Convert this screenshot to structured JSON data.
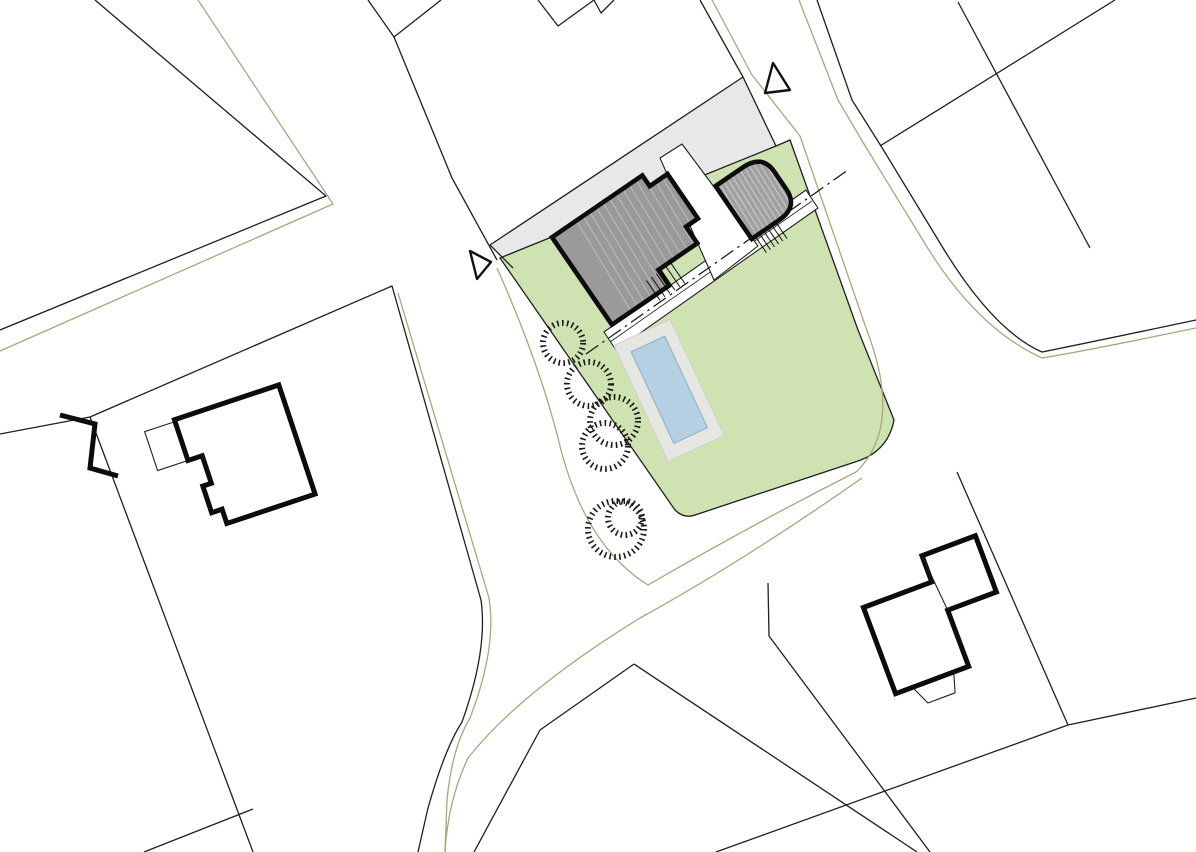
{
  "meta": {
    "type": "architectural-site-plan",
    "description": "Black-and-white cadastral site plan with highlighted project parcel: lawn, main house, garage, terrace, pool, shrubs, access road markers"
  },
  "canvas": {
    "w": 1196,
    "h": 852,
    "bg": "#ffffff"
  },
  "palette": {
    "line": "#1f1f1f",
    "thick": "#0c0c0c",
    "olive": "#a8a67e",
    "driveway": "#e8e8e8",
    "lawn": "#cfe3b2",
    "building_main": "#9a9a9a",
    "building_garage": "#a1a1a1",
    "pool_water": "#b5cfe3",
    "pool_edge": "#98b4c9",
    "deck": "#e6e6e3",
    "white": "#ffffff",
    "hatch_light": "rgba(255,255,255,0.5)",
    "roof_light": "rgba(255,255,255,0.38)",
    "deck_edge": "#d0d0ce"
  },
  "layers": [
    {
      "kind": "polygon",
      "name": "driveway-strip",
      "pts": "743,77 490,245 513,268 776,146",
      "fill": "#e8e8e8",
      "stroke": "none"
    },
    {
      "kind": "path",
      "name": "lawn-parcel",
      "d": "M 500,258 L 675,510 Q 684,519 695,515 L 855,462 Q 888,452 894,420 L 858,330 L 790,140 L 776,146 Z",
      "fill": "#cfe3b2",
      "stroke": "#1f1f1f",
      "w": 1.3
    },
    {
      "kind": "path",
      "name": "driveway-edge-line",
      "d": "M 743,77 L 490,245 M 490,245 L 513,268",
      "fill": "none",
      "stroke": "#1f1f1f",
      "w": 1.3
    },
    {
      "kind": "path",
      "name": "parcel-line-topleft",
      "d": "M 95,0 L 326,196 L 0,330",
      "fill": "none",
      "stroke": "#1f1f1f",
      "w": 1.3
    },
    {
      "kind": "path",
      "name": "parcel-line-v-notch",
      "d": "M 368,0 L 394,37 L 441,0",
      "fill": "none",
      "stroke": "#1f1f1f",
      "w": 1.3
    },
    {
      "kind": "path",
      "name": "road-edge-west-upper",
      "d": "M 394,37 L 452,178 L 497,260",
      "fill": "none",
      "stroke": "#1f1f1f",
      "w": 1.3
    },
    {
      "kind": "path",
      "name": "parcel-line-w-notch",
      "d": "M 538,0 L 558,26 L 594,0 M 594,0 L 601,13 L 614,0",
      "fill": "none",
      "stroke": "#1f1f1f",
      "w": 1.3
    },
    {
      "kind": "path",
      "name": "road-edge-west-of-drive",
      "d": "M 700,0 L 743,77 L 776,146",
      "fill": "none",
      "stroke": "#1f1f1f",
      "w": 1.3
    },
    {
      "kind": "path",
      "name": "road-edge-east",
      "d": "M 817,0 L 852,100 L 881,146 L 940,243 Q 992,330 1042,352 Q 1092,342 1196,320",
      "fill": "none",
      "stroke": "#1f1f1f",
      "w": 1.3
    },
    {
      "kind": "path",
      "name": "parcel-line-topright-1",
      "d": "M 958,2 L 1090,248",
      "fill": "none",
      "stroke": "#1f1f1f",
      "w": 1.3
    },
    {
      "kind": "path",
      "name": "parcel-line-topright-2",
      "d": "M 1115,0 L 880,146",
      "fill": "none",
      "stroke": "#1f1f1f",
      "w": 1.3
    },
    {
      "kind": "path",
      "name": "parcel-line-left",
      "d": "M 0,434 L 90,417 L 392,286 L 481,600 Q 488,650 462,722 Q 445,748 428,808 L 418,852",
      "fill": "none",
      "stroke": "#1f1f1f",
      "w": 1.3
    },
    {
      "kind": "path",
      "name": "parcel-line-left-west",
      "d": "M 90,417 L 253,852",
      "fill": "none",
      "stroke": "#1f1f1f",
      "w": 1.3
    },
    {
      "kind": "path",
      "name": "parcel-line-left-bottom",
      "d": "M 144,852 L 253,809",
      "fill": "none",
      "stroke": "#1f1f1f",
      "w": 1.3
    },
    {
      "kind": "path",
      "name": "parcel-line-south-peak",
      "d": "M 634,664 L 540,730 L 474,852 M 634,664 L 917,852",
      "fill": "none",
      "stroke": "#1f1f1f",
      "w": 1.3
    },
    {
      "kind": "path",
      "name": "parcel-line-southeast",
      "d": "M 957,472 L 1068,725 M 1068,725 L 1196,698 M 1068,725 L 716,852",
      "fill": "none",
      "stroke": "#1f1f1f",
      "w": 1.3
    },
    {
      "kind": "path",
      "name": "parcel-line-right-house",
      "d": "M 768,583 L 769,636 L 930,852",
      "fill": "none",
      "stroke": "#1f1f1f",
      "w": 1.3
    },
    {
      "kind": "path",
      "name": "olive-line-topleft",
      "d": "M 198,0 L 333,204 L 0,351",
      "fill": "none",
      "stroke": "#a8a67e",
      "w": 1.3
    },
    {
      "kind": "path",
      "name": "olive-line-junction-loop",
      "d": "M 497,268 Q 538,360 558,438 Q 583,545 648,585 Q 755,523 856,472",
      "fill": "none",
      "stroke": "#a8a67e",
      "w": 1.3
    },
    {
      "kind": "path",
      "name": "olive-line-east-offset",
      "d": "M 800,136 L 866,328 Q 904,426 856,472",
      "fill": "none",
      "stroke": "#a8a67e",
      "w": 1.3
    },
    {
      "kind": "path",
      "name": "olive-line-sweep",
      "d": "M 862,478 Q 745,560 640,618 Q 520,692 468,758 Q 448,800 445,852",
      "fill": "none",
      "stroke": "#a8a67e",
      "w": 1.3
    },
    {
      "kind": "path",
      "name": "olive-line-left-road",
      "d": "M 398,293 L 489,598 Q 497,648 470,718 Q 452,748 447,800 L 445,852",
      "fill": "none",
      "stroke": "#a8a67e",
      "w": 1.3
    },
    {
      "kind": "path",
      "name": "olive-line-top-road-west",
      "d": "M 712,0 L 752,75 L 800,136",
      "fill": "none",
      "stroke": "#a8a67e",
      "w": 1.3
    },
    {
      "kind": "path",
      "name": "olive-line-top-road-east",
      "d": "M 799,0 L 838,100 L 864,144 L 924,242 Q 976,328 1042,358 Q 1090,350 1196,328",
      "fill": "none",
      "stroke": "#a8a67e",
      "w": 1.3
    },
    {
      "kind": "polygon",
      "name": "terrace-band",
      "pts": "604,332 806,190 818,208 616,350",
      "fill": "#ffffff",
      "stroke": "#1f1f1f",
      "w": 1.1
    },
    {
      "kind": "path",
      "name": "terrace-band-inner-line",
      "d": "M 610,342 L 812,201",
      "fill": "none",
      "stroke": "#1f1f1f",
      "w": 0.8
    },
    {
      "kind": "polygon",
      "name": "terrace-gap",
      "pts": "660,158 682,144 758,246 714,280",
      "fill": "#ffffff",
      "stroke": "#1f1f1f",
      "w": 1.1
    },
    {
      "kind": "group",
      "name": "pool-group",
      "transform": "rotate(-25 670 390)",
      "children": [
        {
          "kind": "rect",
          "name": "pool-deck",
          "x": 638,
          "y": 326,
          "wd": 62,
          "ht": 128,
          "fill": "#e6e6e3",
          "stroke": "#d0d0ce",
          "w": 1
        },
        {
          "kind": "rect",
          "name": "pool-water",
          "x": 651,
          "y": 339,
          "wd": 37,
          "ht": 101,
          "fill": "#b5cfe3",
          "stroke": "#98b4c9",
          "w": 1.2
        }
      ]
    },
    {
      "kind": "path",
      "name": "axis-dashdot-line",
      "d": "M 586,354 L 848,170",
      "fill": "none",
      "stroke": "#111111",
      "w": 1.2,
      "dash": "15 5 2.5 5"
    },
    {
      "kind": "group",
      "name": "main-house-group",
      "transform": "rotate(-34.4 636 244)",
      "clipD": "M 570.5,191 L 680,191 L 680,204 L 701.5,204 L 701.5,258 L 687,258 L 687,278 L 640,278 L 640,297 L 570.5,297 Z",
      "children": [
        {
          "kind": "path",
          "name": "main-house-fill",
          "d": "M 570.5,191 L 680,191 L 680,204 L 701.5,204 L 701.5,258 L 687,258 L 687,278 L 640,278 L 640,297 L 570.5,297 Z",
          "fill": "#9a9a9a",
          "stroke": "none"
        },
        {
          "kind": "hatch",
          "name": "main-house-roof-lines",
          "clip": true,
          "x1": 600,
          "x2": 698,
          "step": 8,
          "y1": 192,
          "y2": 296,
          "slant": -6,
          "stroke": "rgba(255,255,255,0.38)",
          "w": 0.9
        },
        {
          "kind": "hatch",
          "name": "main-house-steps",
          "x1": 624,
          "x2": 654,
          "step": 6,
          "y1": 280,
          "y2": 304,
          "slant": 0,
          "stroke": "#111111",
          "w": 1
        },
        {
          "kind": "path",
          "name": "main-house-outline",
          "d": "M 570.5,191 L 680,191 L 680,204 L 701.5,204 L 701.5,258 L 687,258 L 687,278 L 640,278 L 640,297 L 570.5,297 Z",
          "fill": "none",
          "stroke": "#0c0c0c",
          "w": 4.6,
          "join": "miter"
        }
      ]
    },
    {
      "kind": "group",
      "name": "garage-group",
      "transform": "rotate(-34.4 757 196.5)",
      "clipD": "M 728.7,164.5 L 762,164.5 Q 785.3,164.5 785.3,186 L 785.3,207 Q 785.3,228.5 762,228.5 L 728.7,228.5 Z",
      "children": [
        {
          "kind": "path",
          "name": "garage-fill",
          "d": "M 728.7,164.5 L 762,164.5 Q 785.3,164.5 785.3,186 L 785.3,207 Q 785.3,228.5 762,228.5 L 728.7,228.5 Z",
          "fill": "#a1a1a1",
          "stroke": "none"
        },
        {
          "kind": "hatch",
          "name": "garage-roof-lines",
          "clip": true,
          "x1": 733,
          "x2": 784,
          "step": 5,
          "y1": 166,
          "y2": 227,
          "slant": -3,
          "stroke": "rgba(255,255,255,0.5)",
          "w": 0.9
        },
        {
          "kind": "hatch",
          "name": "garage-steps",
          "x1": 733,
          "x2": 758,
          "step": 5,
          "y1": 229.5,
          "y2": 248,
          "slant": 0,
          "stroke": "#111111",
          "w": 1
        },
        {
          "kind": "path",
          "name": "garage-outline",
          "d": "M 728.7,164.5 L 762,164.5 Q 785.3,164.5 785.3,186 L 785.3,207 Q 785.3,228.5 762,228.5 L 728.7,228.5 Z",
          "fill": "none",
          "stroke": "#0c0c0c",
          "w": 4.6,
          "join": "miter"
        }
      ]
    },
    {
      "kind": "circle",
      "name": "shrub-circle-1",
      "cx": 563,
      "cy": 343,
      "r": 20,
      "fill": "none",
      "stroke": "#1a1a1a",
      "w": 6,
      "dash": "1.6 3.3"
    },
    {
      "kind": "circle",
      "name": "shrub-circle-2",
      "cx": 589,
      "cy": 384,
      "r": 22,
      "fill": "none",
      "stroke": "#1a1a1a",
      "w": 6,
      "dash": "1.6 3.3"
    },
    {
      "kind": "circle",
      "name": "shrub-circle-3",
      "cx": 614,
      "cy": 421,
      "r": 24,
      "fill": "none",
      "stroke": "#1a1a1a",
      "w": 6,
      "dash": "1.6 3.3"
    },
    {
      "kind": "circle",
      "name": "shrub-circle-4",
      "cx": 605,
      "cy": 446,
      "r": 23,
      "fill": "none",
      "stroke": "#1a1a1a",
      "w": 6,
      "dash": "1.6 3.3"
    },
    {
      "kind": "circle",
      "name": "shrub-circle-5",
      "cx": 616,
      "cy": 529,
      "r": 28,
      "fill": "none",
      "stroke": "#1a1a1a",
      "w": 6,
      "dash": "1.6 3.3"
    },
    {
      "kind": "circle",
      "name": "shrub-circle-6",
      "cx": 625,
      "cy": 518,
      "r": 17,
      "fill": "none",
      "stroke": "#1a1a1a",
      "w": 6,
      "dash": "1.6 3.3"
    },
    {
      "kind": "polygon",
      "name": "entrance-marker-west",
      "pts": "470,251 491,262 477,279",
      "fill": "#ffffff",
      "stroke": "#111111",
      "w": 2.4
    },
    {
      "kind": "polygon",
      "name": "entrance-marker-north",
      "pts": "773,63 790,90 765,93",
      "fill": "#ffffff",
      "stroke": "#111111",
      "w": 2.4
    },
    {
      "kind": "group",
      "name": "neighbor-house-west-group",
      "transform": "rotate(-18.4 243 458)",
      "children": [
        {
          "kind": "path",
          "name": "neighbor-house-west-annex",
          "d": "M 158,402 L 190,402 L 190,443 L 158,443 Z",
          "fill": "#ffffff",
          "stroke": "#1f1f1f",
          "w": 1.1
        },
        {
          "kind": "path",
          "name": "neighbor-house-west",
          "d": "M 190,400 L 300,400 L 300,515 L 207,515 L 207,500 L 196,500 L 196,472 L 205,472 L 205,443 L 190,443 Z",
          "fill": "#ffffff",
          "stroke": "#0c0c0c",
          "w": 5,
          "join": "miter"
        }
      ]
    },
    {
      "kind": "group",
      "name": "neighbor-house-east-group",
      "transform": "rotate(-20.5 930 620)",
      "children": [
        {
          "kind": "path",
          "name": "neighbor-house-east-porch",
          "d": "M 890,677 L 934,677 L 928,697 L 899,697 Z",
          "fill": "#ffffff",
          "stroke": "#1f1f1f",
          "w": 1.1
        },
        {
          "kind": "path",
          "name": "neighbor-house-east",
          "d": "M 872,585 L 945,585 L 945,557 L 1002,557 L 1002,617 L 950,617 L 950,677 L 872,677 Z",
          "fill": "#ffffff",
          "stroke": "#0c0c0c",
          "w": 5,
          "join": "miter"
        },
        {
          "kind": "path",
          "name": "neighbor-house-east-divider",
          "d": "M 945,557 L 950,617",
          "fill": "none",
          "stroke": "#1f1f1f",
          "w": 1.1
        }
      ]
    },
    {
      "kind": "path",
      "name": "edge-building-fragment",
      "d": "M 60,415 L 95,424 L 90,468 L 118,476",
      "fill": "none",
      "stroke": "#0c0c0c",
      "w": 5,
      "join": "miter"
    }
  ]
}
